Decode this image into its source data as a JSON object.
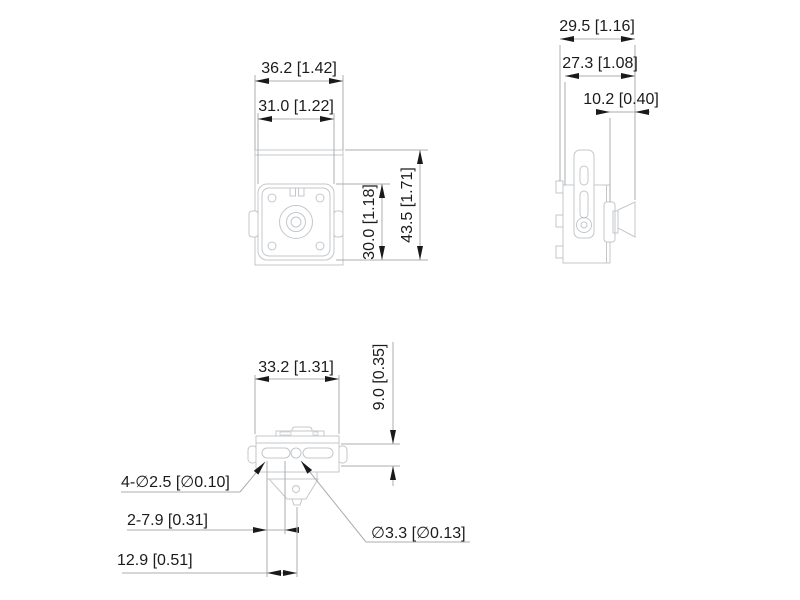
{
  "title": "camera-dimension-drawing",
  "colors": {
    "background": "#ffffff",
    "outline": "#c3c7cb",
    "dimension_line": "#a9adb2",
    "arrow": "#1a1a1a",
    "text": "#1b1b1b"
  },
  "views": {
    "front": {
      "dims": {
        "outer_width": "36.2 [1.42]",
        "plate_width": "31.0 [1.22]",
        "plate_height": "30.0 [1.18]",
        "overall_height": "43.5 [1.71]"
      }
    },
    "side": {
      "dims": {
        "overall_depth": "29.5 [1.16]",
        "body_depth": "27.3 [1.08]",
        "lens_length": "10.2 [0.40]"
      }
    },
    "bottom": {
      "dims": {
        "body_width": "33.2 [1.31]",
        "body_depth": "9.0 [0.35]",
        "slot_holes": "4-∅2.5 [∅0.10]",
        "slot_length": "2-7.9 [0.31]",
        "hole_offset": "12.9 [0.51]",
        "center_hole": "∅3.3 [∅0.13]"
      }
    }
  }
}
